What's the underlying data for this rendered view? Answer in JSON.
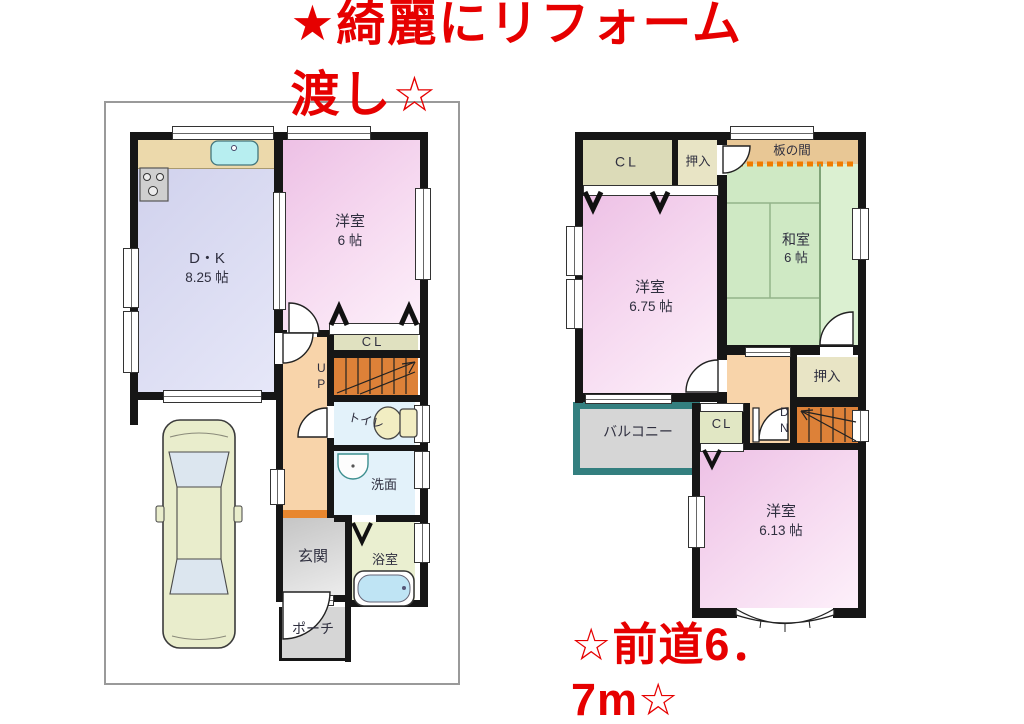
{
  "title": "★綺麗にリフォーム渡し☆",
  "front_road_note": "☆前道6．7m☆",
  "accent_color": "#e60000",
  "floor1": {
    "dk": {
      "name": "D・K",
      "size": "8.25 帖"
    },
    "western6": {
      "name": "洋室",
      "size": "6 帖"
    },
    "closet": "CL",
    "stairs": "UP",
    "toilet": "トイレ",
    "washroom": "洗面",
    "entrance": "玄関",
    "bathroom": "浴室",
    "porch": "ポーチ"
  },
  "floor2": {
    "closet_top": "CL",
    "oshiire_top": "押入",
    "itanoma": "板の間",
    "japanese6": {
      "name": "和室",
      "size": "6 帖"
    },
    "western675": {
      "name": "洋室",
      "size": "6.75 帖"
    },
    "oshiire_right": "押入",
    "stairs": "DN",
    "balcony": "バルコニー",
    "closet_small": "CL",
    "western613": {
      "name": "洋室",
      "size": "6.13 帖"
    }
  }
}
